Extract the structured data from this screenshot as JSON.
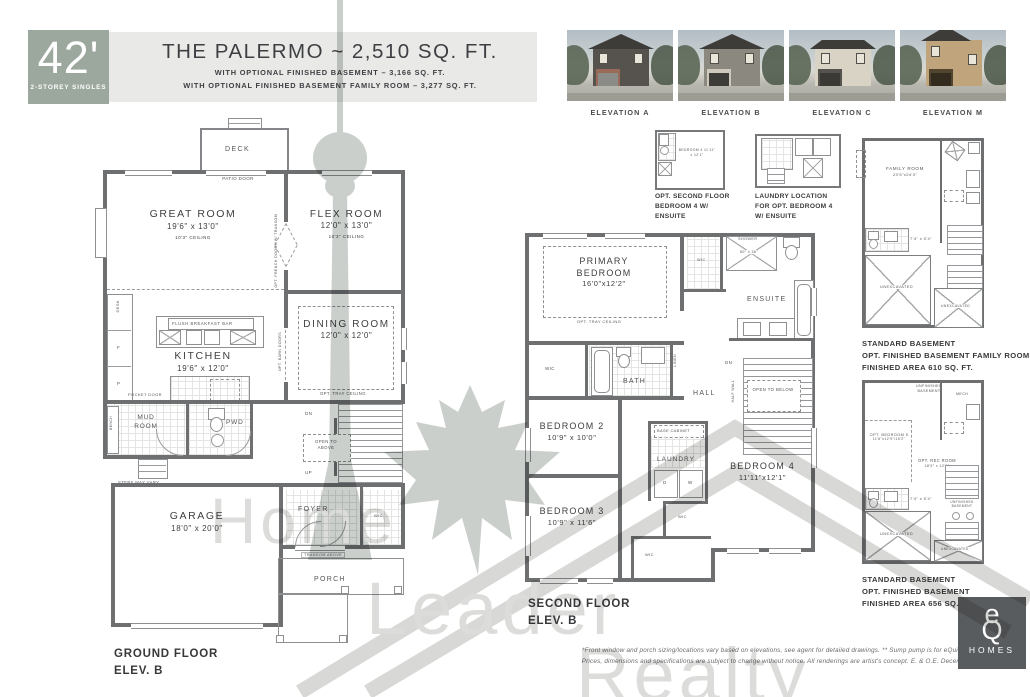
{
  "header": {
    "badge_width": "42'",
    "badge_subtitle": "2-STOREY SINGLES",
    "title": "THE PALERMO ~ 2,510 SQ. FT.",
    "subtitle1": "WITH OPTIONAL FINISHED BASEMENT – 3,166 SQ. FT.",
    "subtitle2": "WITH OPTIONAL FINISHED BASEMENT FAMILY ROOM – 3,277 SQ. FT."
  },
  "elevations": [
    {
      "label": "ELEVATION A"
    },
    {
      "label": "ELEVATION B"
    },
    {
      "label": "ELEVATION C"
    },
    {
      "label": "ELEVATION M"
    }
  ],
  "watermark": {
    "word1": "Home",
    "word2": "Leader",
    "word3": "Realty"
  },
  "ground_floor": {
    "deck": "DECK",
    "patio_door": "PATIO DOOR",
    "great_room_name": "GREAT ROOM",
    "great_room_dims": "19'6\" x 13'0\"",
    "great_room_ceiling": "10'3\" CEILING",
    "flex_room_name": "FLEX ROOM",
    "flex_room_dims": "12'0\" x 13'0\"",
    "flex_room_ceiling": "10'3\" CEILING",
    "opt_french_doors": "OPT. FRENCH DOORS W/ TRANSOM",
    "desk": "DESK",
    "fridge": "F",
    "pantry": "P",
    "flush_breakfast_bar": "FLUSH BREAKFAST BAR",
    "kitchen_name": "KITCHEN",
    "kitchen_dims": "19'6\" x 12'0\"",
    "dining_room_name": "DINING ROOM",
    "dining_room_dims": "12'0\" x 12'0\"",
    "dining_tray": "OPT. TRAY CEILING",
    "opt_barn_doors": "OPT. BARN DOORS",
    "pocket_door": "POCKET DOOR",
    "bench": "BENCH",
    "mud_room": "MUD ROOM",
    "pwd": "PWD",
    "steps_may_vary": "STEPS MAY VARY",
    "garage_name": "GARAGE",
    "garage_dims": "18'0\" x 20'0\"",
    "dn": "DN",
    "up": "UP",
    "open_to_above": "OPEN TO ABOVE",
    "foyer": "FOYER",
    "wic": "WIC",
    "transom_above": "TRANSOM ABOVE",
    "porch": "PORCH",
    "caption_line1": "GROUND FLOOR",
    "caption_line2": "ELEV. B"
  },
  "second_floor": {
    "inset1_room": "BEDROOM 4",
    "inset1_dims": "11'11\" x 12'1\"",
    "inset1_caption1": "OPT. SECOND FLOOR",
    "inset1_caption2": "BEDROOM 4 W/",
    "inset1_caption3": "ENSUITE",
    "inset2_caption1": "LAUNDRY LOCATION",
    "inset2_caption2": "FOR OPT. BEDROOM 4",
    "inset2_caption3": "W/ ENSUITE",
    "primary_name1": "PRIMARY",
    "primary_name2": "BEDROOM",
    "primary_dims": "16'0\"x12'2\"",
    "primary_tray": "OPT. TRAY CEILING",
    "shower": "SHOWER",
    "shower_dims": "60\" x 36\"",
    "wic": "WIC",
    "ensuite": "ENSUITE",
    "bath": "BATH",
    "linen": "LINEN",
    "hall": "HALL",
    "dn": "DN",
    "half_wall": "HALF WALL",
    "open_to_below": "OPEN TO BELOW",
    "bedroom2_name": "BEDROOM 2",
    "bedroom2_dims": "10'9\" x 10'0\"",
    "bedroom3_name": "BEDROOM 3",
    "bedroom3_dims": "10'9\" x 11'6\"",
    "bedroom4_name": "BEDROOM 4",
    "bedroom4_dims": "11'11\"x12'1\"",
    "base_cabinet": "BASE CABINET",
    "laundry": "LAUNDRY",
    "dryer": "D",
    "washer": "W",
    "caption_line1": "SECOND FLOOR",
    "caption_line2": "ELEV. B"
  },
  "basement1": {
    "family_room_name": "FAMILY ROOM",
    "family_room_dims": "23'5\"x24'3\"",
    "closet_dims": "7'4\" x 5'4\"",
    "unexcavated": "UNEXCAVATED",
    "caption_line1": "STANDARD BASEMENT",
    "caption_line2": "OPT. FINISHED BASEMENT FAMILY ROOM",
    "caption_line3": "FINISHED AREA 610 SQ. FT."
  },
  "basement2": {
    "unfinished_basement": "UNFINISHED BASEMENT",
    "mech": "MECH",
    "bedroom5_name": "OPT. BEDROOM 5",
    "bedroom5_dims": "11'6\"x12'9\"/15'2\"",
    "rec_room_name": "OPT. REC ROOM",
    "rec_room_dims": "18'5\" x 12'0\"",
    "closet_dims": "7'4\" x 5'4\"",
    "unexcavated": "UNEXCAVATED",
    "unfinished_small": "UNFINISHED BASEMENT",
    "caption_line1": "STANDARD BASEMENT",
    "caption_line2": "OPT. FINISHED BASEMENT",
    "caption_line3": "FINISHED AREA 656 SQ. FT."
  },
  "footer": {
    "disclaimer1": "*Front window and porch sizing/locations vary based on elevations, see agent for detailed drawings.  ** Sump pump is for eQuinelle only.",
    "disclaimer2": "Prices, dimensions and specifications are subject to change without notice. All renderings are artist's concept. E. & O.E. December 2022",
    "logo_e": "e",
    "logo_q": "Q",
    "logo_homes": "HOMES"
  },
  "colors": {
    "badge": "#9CA89E",
    "wall": "#6E6F71",
    "header_strip": "#E9E9E7",
    "logo_bg": "#595C5E"
  }
}
